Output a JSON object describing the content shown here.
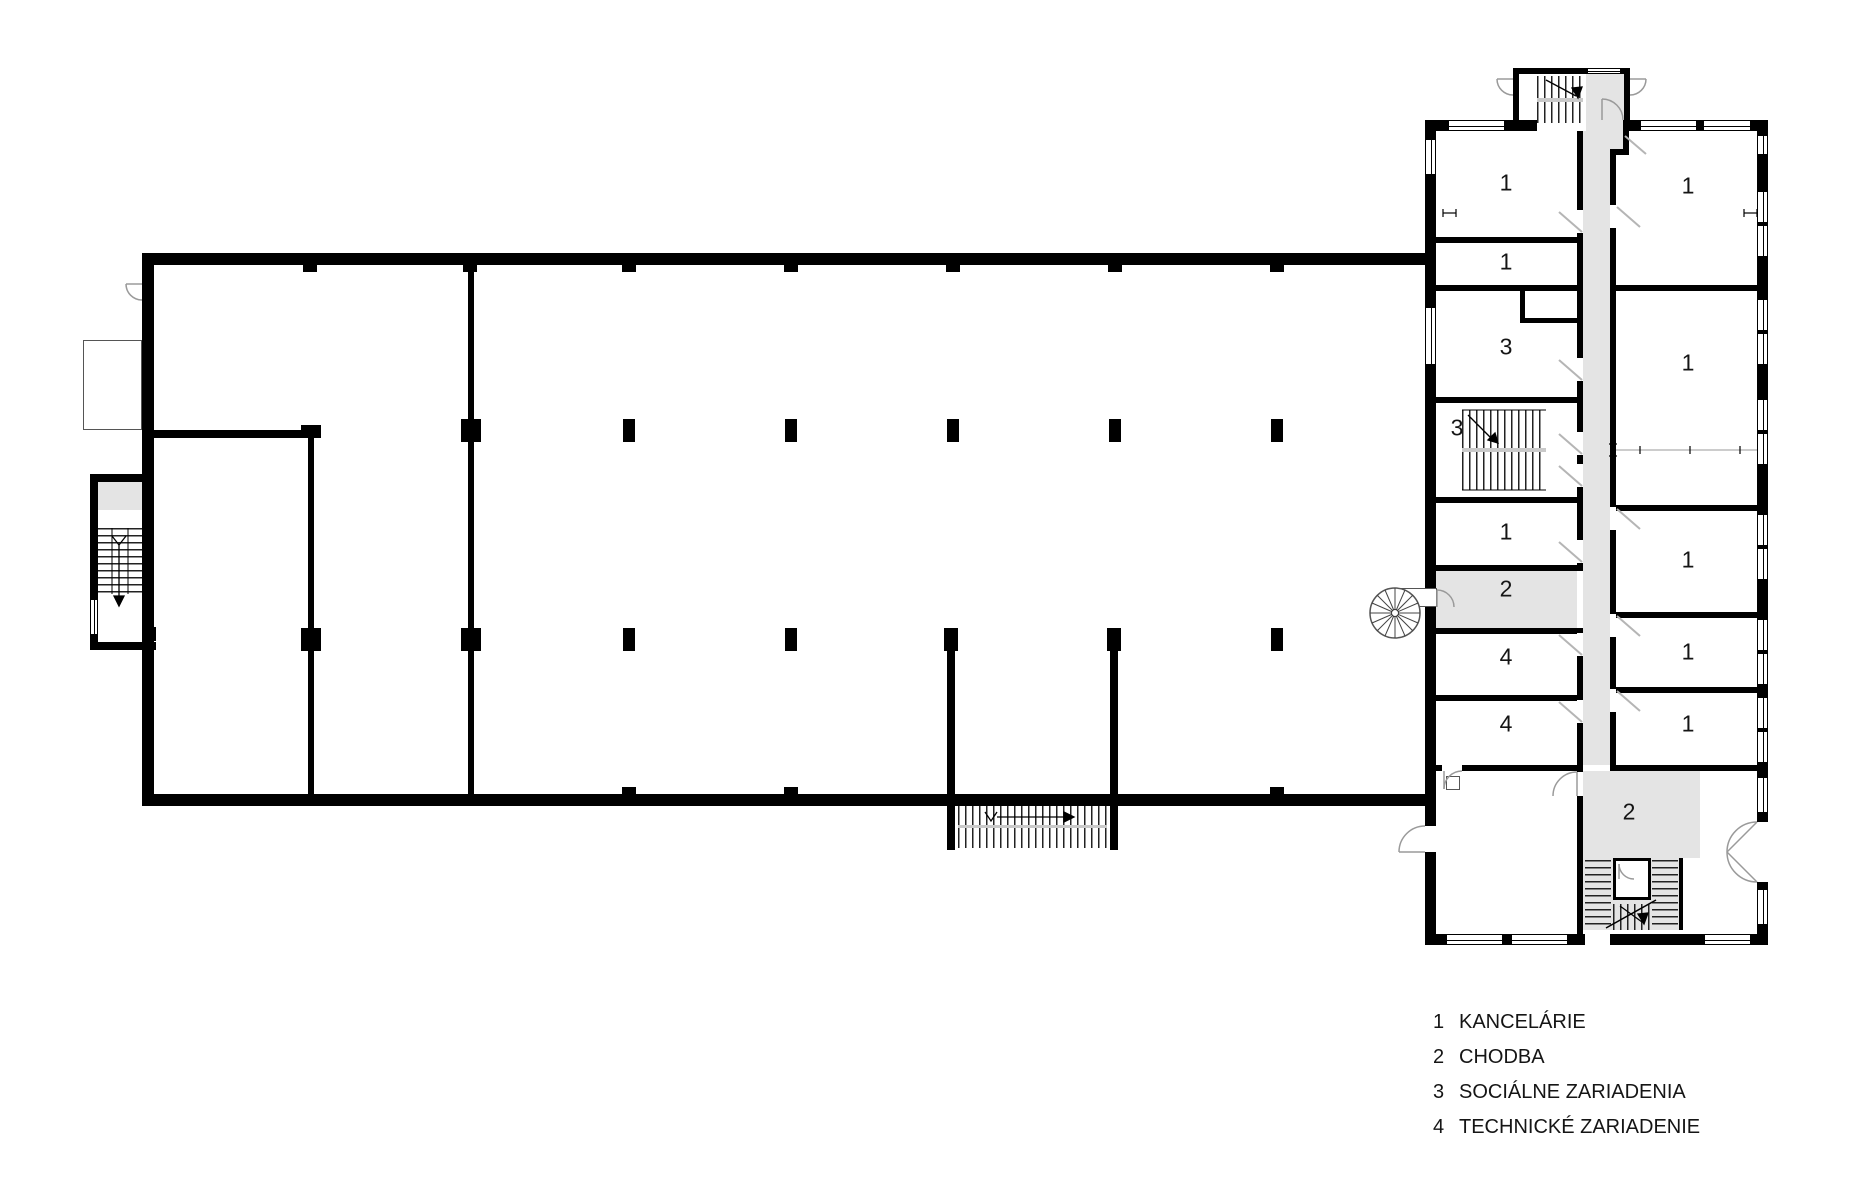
{
  "title": "Floor plan – administrative building",
  "colors": {
    "wall": "#000000",
    "corridor_fill": "#e4e4e4",
    "door_arc": "#9a9a9a",
    "door_leaf": "#b5b5b5",
    "text": "#151515"
  },
  "room_labels": [
    {
      "text": "1",
      "x": 1506,
      "y": 183
    },
    {
      "text": "1",
      "x": 1506,
      "y": 262
    },
    {
      "text": "3",
      "x": 1506,
      "y": 347
    },
    {
      "text": "3",
      "x": 1457,
      "y": 428
    },
    {
      "text": "1",
      "x": 1506,
      "y": 532
    },
    {
      "text": "2",
      "x": 1506,
      "y": 589
    },
    {
      "text": "4",
      "x": 1506,
      "y": 657
    },
    {
      "text": "4",
      "x": 1506,
      "y": 724
    },
    {
      "text": "2",
      "x": 1629,
      "y": 812
    },
    {
      "text": "1",
      "x": 1688,
      "y": 186
    },
    {
      "text": "1",
      "x": 1688,
      "y": 363
    },
    {
      "text": "1",
      "x": 1688,
      "y": 560
    },
    {
      "text": "1",
      "x": 1688,
      "y": 652
    },
    {
      "text": "1",
      "x": 1688,
      "y": 724
    }
  ],
  "legend": {
    "x": 1433,
    "y": 1005,
    "items": [
      {
        "num": "1",
        "label": "KANCELÁRIE"
      },
      {
        "num": "2",
        "label": "CHODBA"
      },
      {
        "num": "3",
        "label": "SOCIÁLNE ZARIADENIA"
      },
      {
        "num": "4",
        "label": "TECHNICKÉ ZARIADENIE"
      }
    ]
  }
}
